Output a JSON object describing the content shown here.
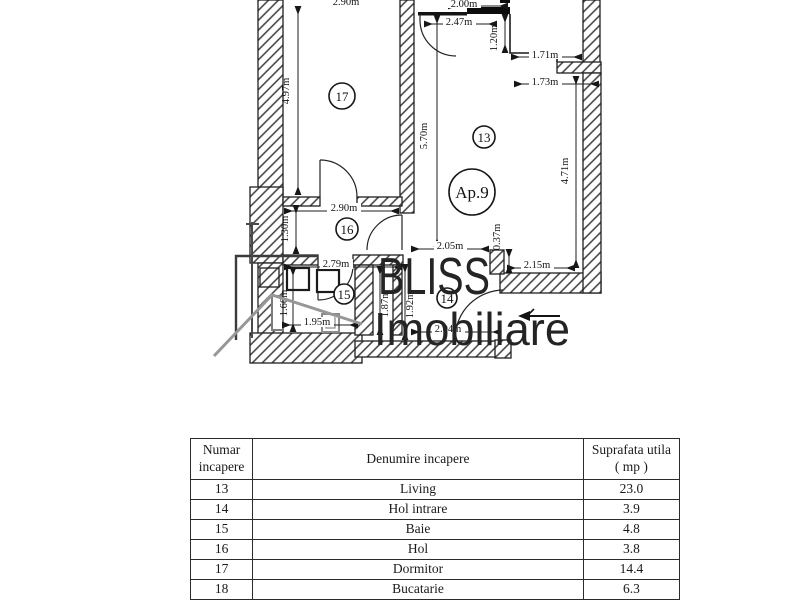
{
  "logo": {
    "brand": "BLISS",
    "subtitle": "Imobiliare"
  },
  "plan": {
    "apartment_label": "Ap.9",
    "rooms": {
      "dormitor": "17",
      "living": "13",
      "hol": "16",
      "baie": "15",
      "hol_intrare": "14"
    },
    "dimensions": {
      "top_partial": "2.90m",
      "d200": "2.00m",
      "d247": "2.47m",
      "d120": "1.20m",
      "d171": "1.71m",
      "d173": "1.73m",
      "d497": "4.97m",
      "d570": "5.70m",
      "d471": "4.71m",
      "d290": "2.90m",
      "d130": "1.30m",
      "d205": "2.05m",
      "d037": "0.37m",
      "d215": "2.15m",
      "d279": "2.79m",
      "d166": "1.66m",
      "d187": "1.87m",
      "d192": "1.92m",
      "d195": "1.95m",
      "d204": "2.04m"
    }
  },
  "table": {
    "headers": {
      "numar_line1": "Numar",
      "numar_line2": "incapere",
      "denumire": "Denumire incapere",
      "suprafata_line1": "Suprafata utila",
      "suprafata_line2": "( mp )"
    },
    "rows": [
      {
        "nr": "13",
        "name": "Living",
        "area": "23.0"
      },
      {
        "nr": "14",
        "name": "Hol intrare",
        "area": "3.9"
      },
      {
        "nr": "15",
        "name": "Baie",
        "area": "4.8"
      },
      {
        "nr": "16",
        "name": "Hol",
        "area": "3.8"
      },
      {
        "nr": "17",
        "name": "Dormitor",
        "area": "14.4"
      },
      {
        "nr": "18",
        "name": "Bucatarie",
        "area": "6.3"
      }
    ]
  }
}
